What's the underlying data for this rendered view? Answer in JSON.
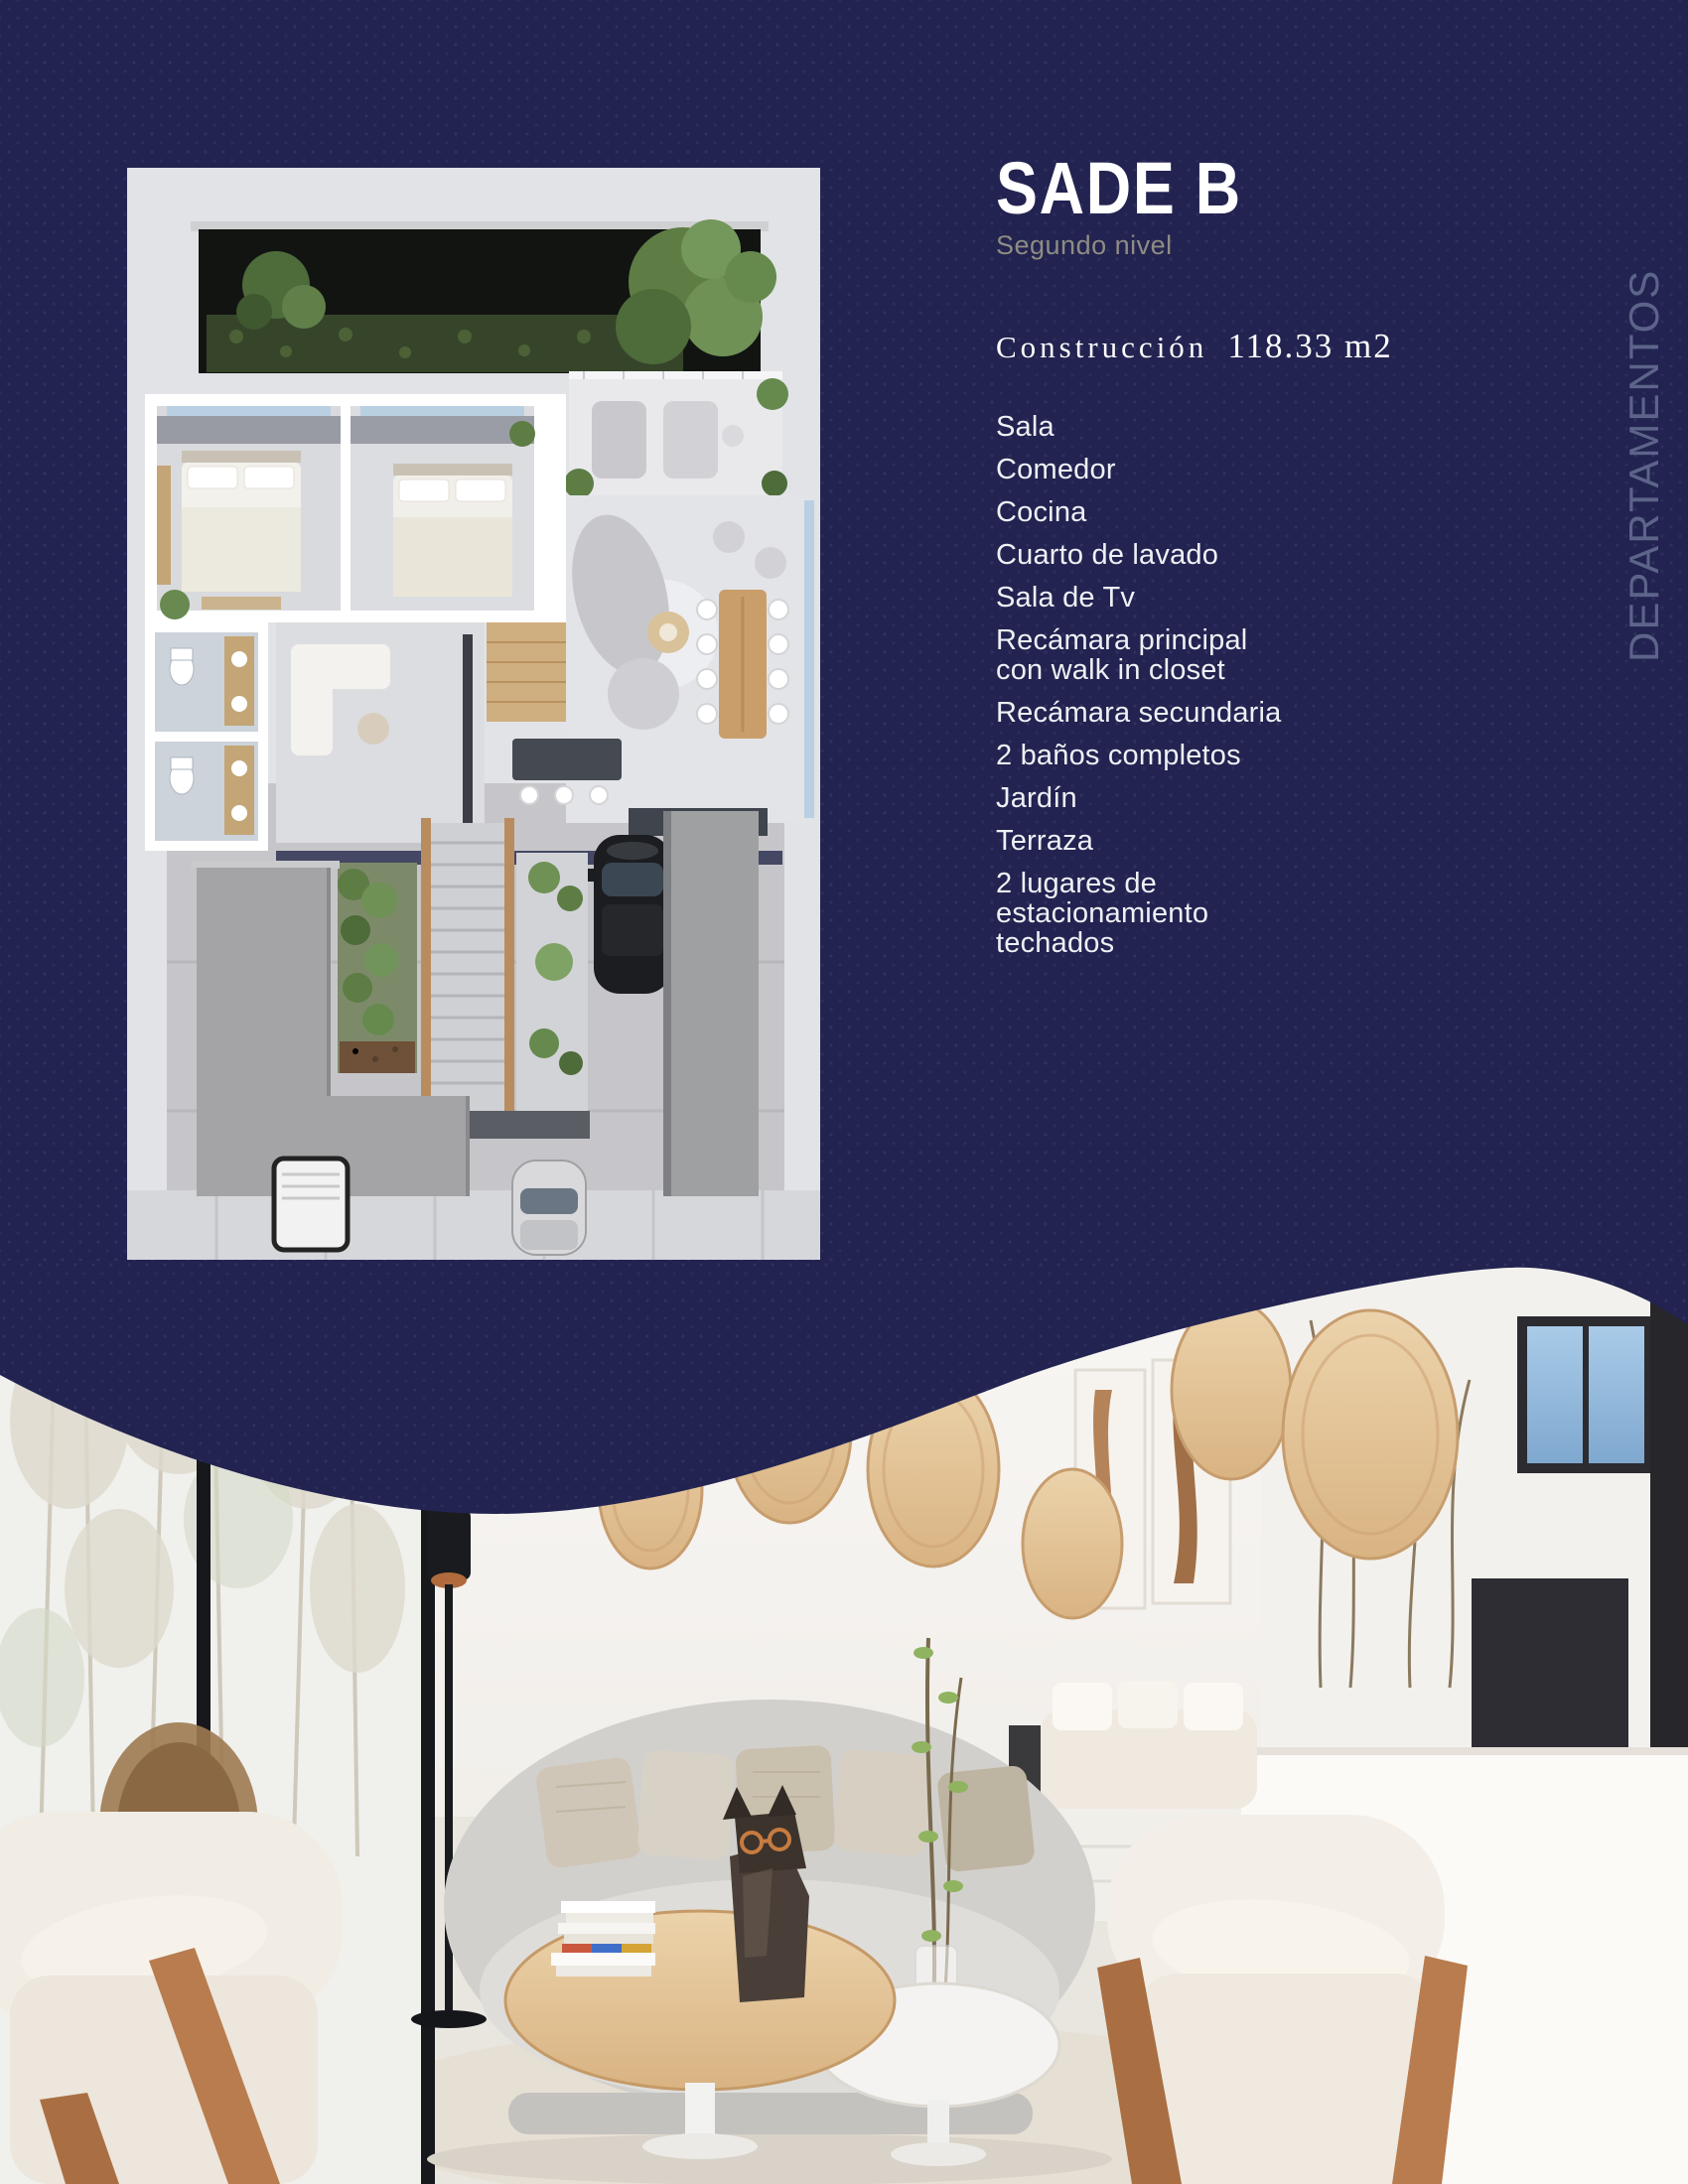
{
  "colors": {
    "navy": "#222350",
    "card-bg": "#e2e3e7",
    "title": "#ffffff",
    "muted": "#8e8c84",
    "list": "#eef0f5",
    "watermark": "#5c6489"
  },
  "panel": {
    "title": "SADE B",
    "subtitle": "Segundo nivel",
    "construction_label": "Construcción",
    "construction_value": "118.33 m2",
    "features": [
      "Sala",
      "Comedor",
      "Cocina",
      "Cuarto de lavado",
      "Sala de Tv",
      "Recámara principal\ncon walk in closet",
      "Recámara secundaria",
      "2 baños completos",
      "Jardín",
      "Terraza",
      "2 lugares de\nestacionamiento\ntechados"
    ]
  },
  "side_label": "DEPARTAMENTOS"
}
